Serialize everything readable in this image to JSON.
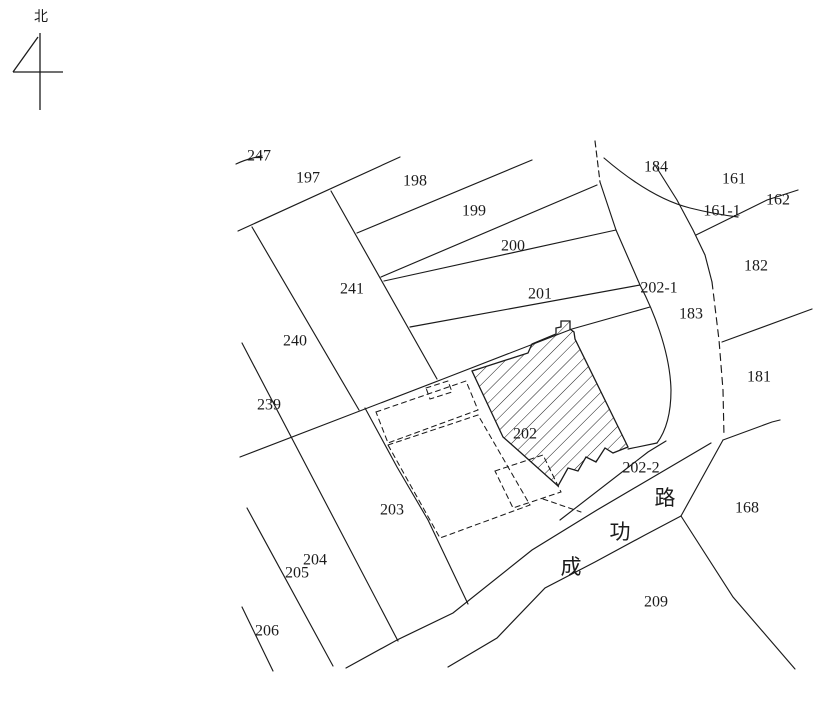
{
  "map": {
    "type": "cadastral-parcel-map",
    "north_label": "北",
    "road_name": "成功路",
    "road_name_chars": [
      {
        "char": "成",
        "x": 571,
        "y": 567
      },
      {
        "char": "功",
        "x": 620,
        "y": 532
      },
      {
        "char": "路",
        "x": 665,
        "y": 498
      }
    ],
    "parcels": [
      {
        "id": "247",
        "x": 259,
        "y": 156
      },
      {
        "id": "197",
        "x": 308,
        "y": 178
      },
      {
        "id": "198",
        "x": 415,
        "y": 181
      },
      {
        "id": "199",
        "x": 474,
        "y": 211
      },
      {
        "id": "200",
        "x": 513,
        "y": 246
      },
      {
        "id": "201",
        "x": 540,
        "y": 294
      },
      {
        "id": "241",
        "x": 352,
        "y": 289
      },
      {
        "id": "240",
        "x": 295,
        "y": 341
      },
      {
        "id": "239",
        "x": 269,
        "y": 405
      },
      {
        "id": "202-1",
        "x": 659,
        "y": 288
      },
      {
        "id": "184",
        "x": 656,
        "y": 167
      },
      {
        "id": "161",
        "x": 734,
        "y": 179
      },
      {
        "id": "161-1",
        "x": 722,
        "y": 211
      },
      {
        "id": "162",
        "x": 778,
        "y": 200
      },
      {
        "id": "182",
        "x": 756,
        "y": 266
      },
      {
        "id": "183",
        "x": 691,
        "y": 314
      },
      {
        "id": "181",
        "x": 759,
        "y": 377
      },
      {
        "id": "202",
        "x": 525,
        "y": 434
      },
      {
        "id": "202-2",
        "x": 641,
        "y": 468
      },
      {
        "id": "203",
        "x": 392,
        "y": 510
      },
      {
        "id": "204",
        "x": 315,
        "y": 560
      },
      {
        "id": "205",
        "x": 297,
        "y": 573
      },
      {
        "id": "206",
        "x": 267,
        "y": 631
      },
      {
        "id": "168",
        "x": 747,
        "y": 508
      },
      {
        "id": "209",
        "x": 656,
        "y": 602
      }
    ],
    "colors": {
      "background": "#ffffff",
      "line": "#1b1b1b"
    },
    "legend": {
      "hatched_parcel": "202",
      "dashed_outlines": "building-footprints"
    }
  }
}
